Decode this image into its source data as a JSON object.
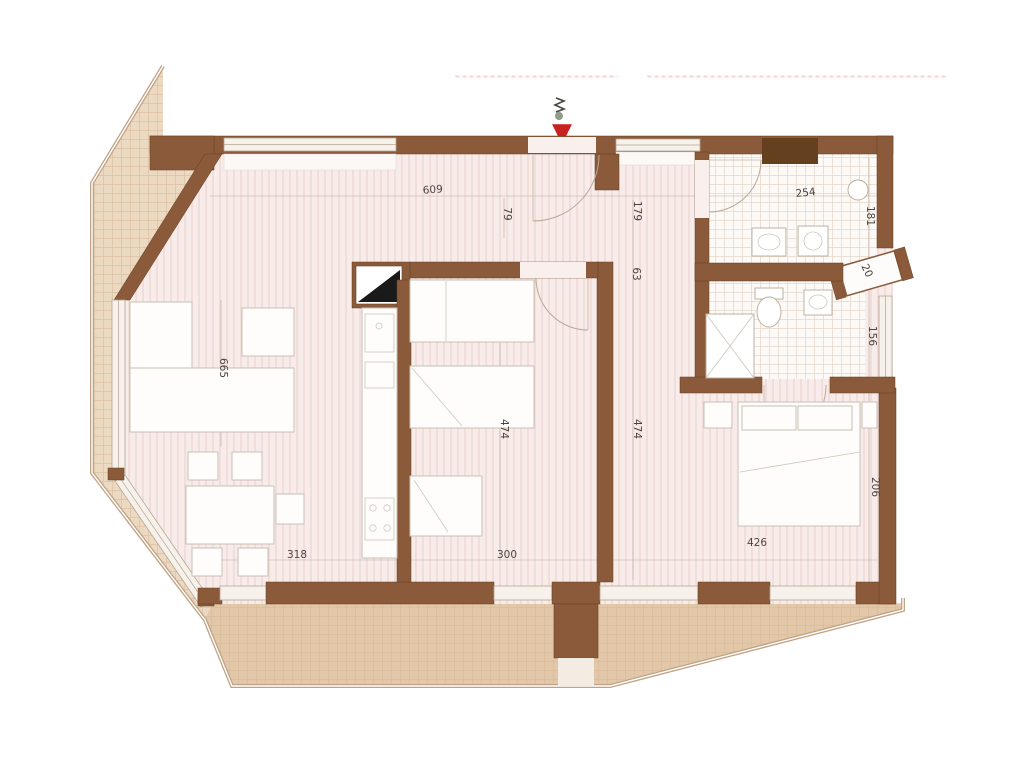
{
  "colors": {
    "wall": "#8a5a3a",
    "wall-dark": "#64401f",
    "floor-pink": "#f8ecea",
    "floor-pink-hatch": "#ead0cb",
    "balcony-beige": "#ecd9c2",
    "balcony-tan": "#d8b78f",
    "tile-white": "#fcf9f6",
    "tile-line": "#e5d8cb",
    "dim-text": "#4a443f",
    "dim-line": "#b9aa9c",
    "arrow-red": "#c92020",
    "watermark": "#cf6a5a"
  },
  "icons": {
    "entrance_arrow": "▼"
  },
  "plan": {
    "dimension_labels": [
      {
        "text": "609",
        "x": 433,
        "y": 193,
        "rotate": -4
      },
      {
        "text": "79",
        "x": 504,
        "y": 214,
        "rotate": 90
      },
      {
        "text": "179",
        "x": 634,
        "y": 211,
        "rotate": 90
      },
      {
        "text": "63",
        "x": 633,
        "y": 274,
        "rotate": 90
      },
      {
        "text": "254",
        "x": 806,
        "y": 196,
        "rotate": -6
      },
      {
        "text": "181",
        "x": 867,
        "y": 216,
        "rotate": 90
      },
      {
        "text": "20",
        "x": 864,
        "y": 272,
        "rotate": 65
      },
      {
        "text": "156",
        "x": 869,
        "y": 336,
        "rotate": 90
      },
      {
        "text": "665",
        "x": 220,
        "y": 368,
        "rotate": 90
      },
      {
        "text": "474",
        "x": 501,
        "y": 429,
        "rotate": 90
      },
      {
        "text": "474",
        "x": 634,
        "y": 429,
        "rotate": 90
      },
      {
        "text": "318",
        "x": 297,
        "y": 558,
        "rotate": 0
      },
      {
        "text": "300",
        "x": 507,
        "y": 558,
        "rotate": 0
      },
      {
        "text": "426",
        "x": 757,
        "y": 546,
        "rotate": 0
      },
      {
        "text": "206",
        "x": 872,
        "y": 487,
        "rotate": 90
      }
    ]
  }
}
